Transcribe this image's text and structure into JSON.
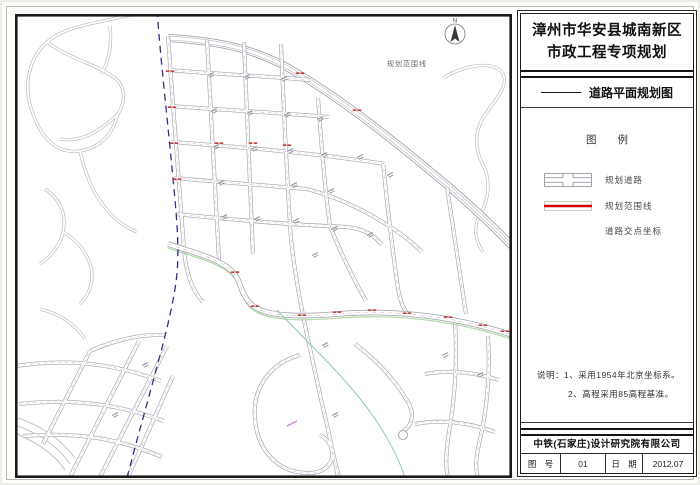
{
  "document": {
    "title_line1": "漳州市华安县城南新区",
    "title_line2": "市政工程专项规划",
    "drawing_name": "道路平面规划图"
  },
  "legend": {
    "heading": "图 例",
    "items": [
      {
        "name": "planned-road",
        "label": "规划道路"
      },
      {
        "name": "planning-boundary-line",
        "label": "规划范围线"
      },
      {
        "name": "road-intersection-coordinates",
        "label": "道路交点坐标"
      }
    ]
  },
  "notes": {
    "line1": "说明：1、采用1954年北京坐标系。",
    "line2": "2、高程采用85高程基准。"
  },
  "title_block": {
    "company": "中铁(石家庄)设计研究院有限公司",
    "sheet_no_label": "图 号",
    "sheet_no": "01",
    "date_label": "日 期",
    "date": "2012.07"
  },
  "map": {
    "boundary_label": "规划范围线",
    "compass_letter": "N"
  },
  "colors": {
    "boundary_red": "#d40000",
    "road_casing": "#a4a4ac",
    "stream_blue": "#30308a",
    "river_cyan": "#8cc8be"
  }
}
